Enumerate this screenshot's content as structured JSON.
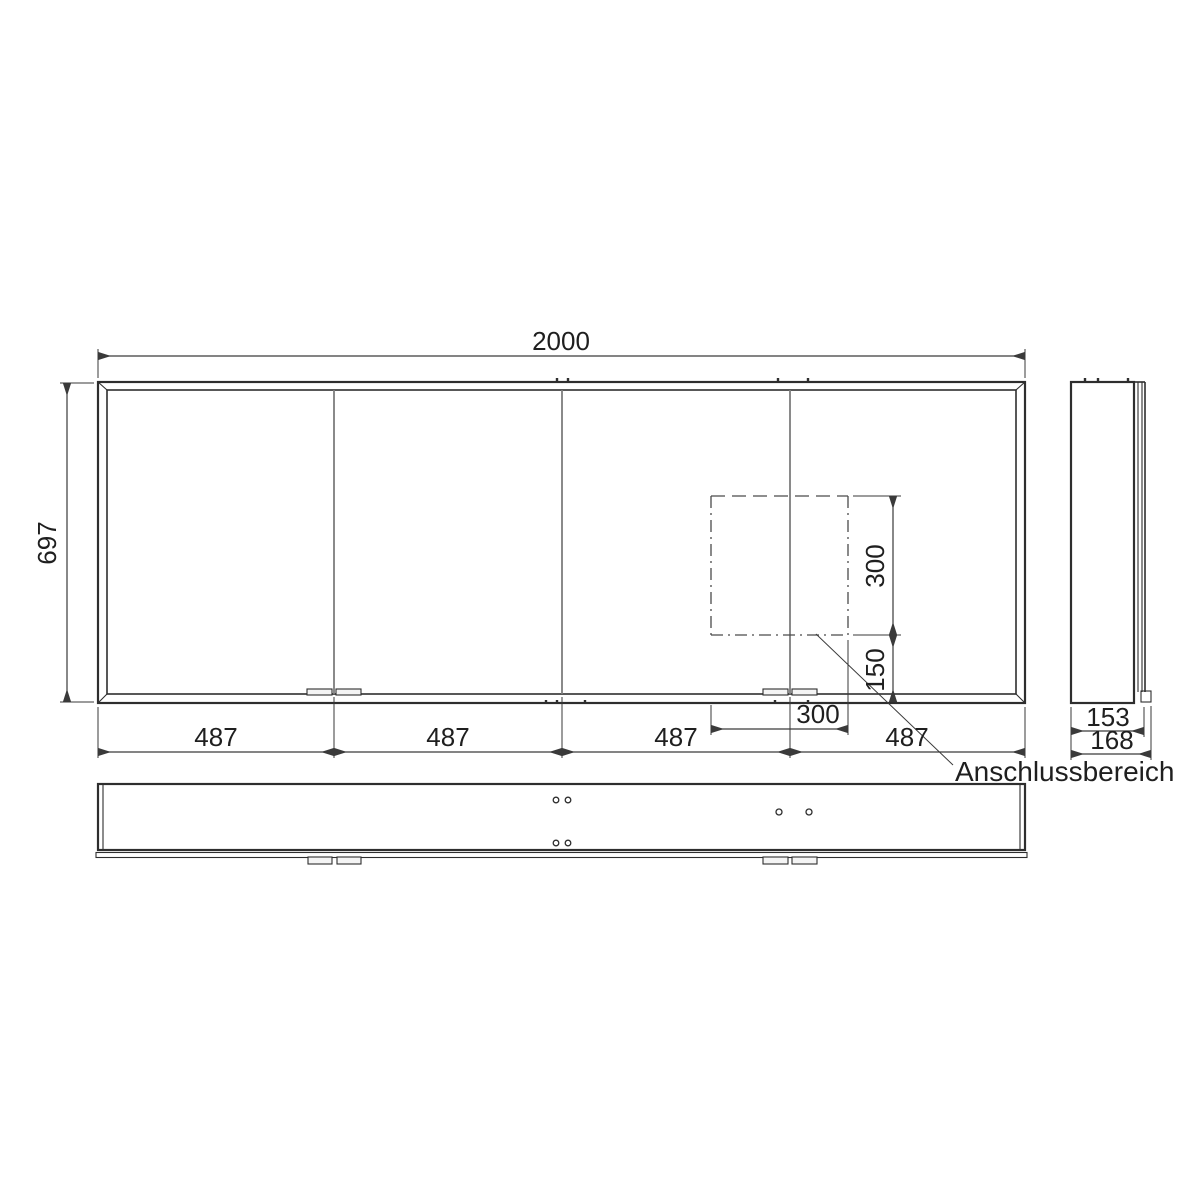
{
  "drawing": {
    "front_view": {
      "overall_width_mm": "2000",
      "overall_height_mm": "697",
      "door_widths_mm": [
        "487",
        "487",
        "487",
        "487"
      ]
    },
    "connection_area": {
      "label": "Anschlussbereich",
      "width_mm": "300",
      "height_mm": "300",
      "offset_from_bottom_mm": "150"
    },
    "side_view": {
      "depth_body_mm": "153",
      "depth_total_mm": "168"
    },
    "colors": {
      "line": "#2e2e2e",
      "divider": "#7d7d7d",
      "background": "#ffffff"
    }
  }
}
